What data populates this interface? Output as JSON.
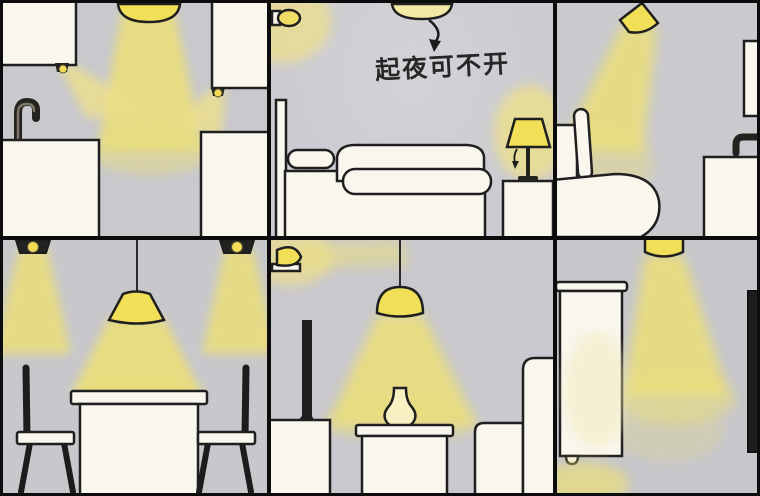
{
  "annotation": {
    "bedroom_note": "起夜可不开"
  },
  "colors": {
    "frame_black": "#0c0c0c",
    "wall_gray": "#c9c9ce",
    "furniture_white": "#f9f6ee",
    "light_beam_yellow": "#ebdf79",
    "lamp_lit_yellow": "#f2df58",
    "lamp_off_pale_yellow": "#f3e9a6",
    "outline_ink": "#1f1f1f",
    "dark_object": "#222220"
  },
  "scene": {
    "panels": [
      {
        "id": "kitchen",
        "fixtures": [
          "ceiling-dome-light",
          "under-cabinet-light-left",
          "under-cabinet-light-right"
        ],
        "furniture": [
          "upper-cabinet-left",
          "upper-cabinet-right",
          "sink-counter",
          "faucet",
          "base-cabinet"
        ]
      },
      {
        "id": "bedroom",
        "fixtures": [
          "ceiling-dome-light-off",
          "wall-night-light",
          "bedside-table-lamp"
        ],
        "furniture": [
          "bed",
          "pillow",
          "headboard",
          "nightstand"
        ],
        "annotation": "起夜可不开"
      },
      {
        "id": "toilet",
        "fixtures": [
          "angled-spotlight"
        ],
        "furniture": [
          "toilet-with-lid-up",
          "mirror",
          "faucet",
          "sink-vanity"
        ]
      },
      {
        "id": "dining",
        "fixtures": [
          "ceiling-spot-left",
          "ceiling-spot-right",
          "pendant-lamp"
        ],
        "furniture": [
          "dining-table",
          "chair-left",
          "chair-right"
        ]
      },
      {
        "id": "living",
        "fixtures": [
          "wall-sconce",
          "pendant-dome-lamp"
        ],
        "furniture": [
          "tv",
          "tv-cabinet",
          "coffee-table",
          "vase",
          "sofa"
        ]
      },
      {
        "id": "entry",
        "fixtures": [
          "ceiling-cylinder-light"
        ],
        "furniture": [
          "shoe-cabinet",
          "dark-door-panel"
        ]
      }
    ]
  }
}
